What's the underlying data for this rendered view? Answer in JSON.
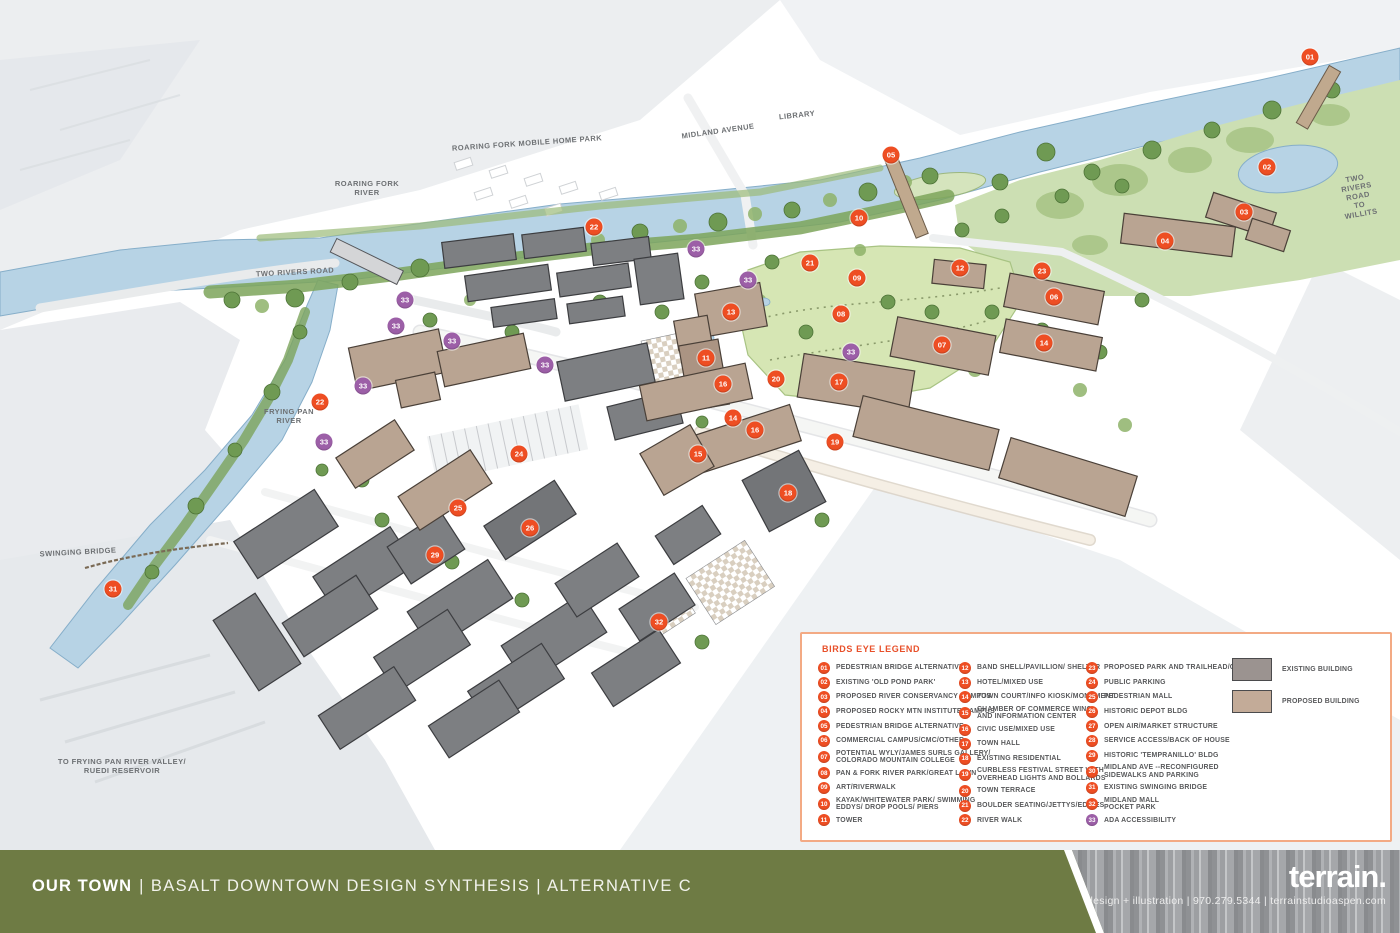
{
  "colors": {
    "marker_orange": "#ee4e23",
    "marker_purple": "#9c5fa7",
    "footer_green": "#6e7b44",
    "legend_border": "#f3aa84",
    "existing_building": "#9b9390",
    "proposed_building": "#c3ab98"
  },
  "map": {
    "labels": [
      {
        "text": "ROARING FORK MOBILE HOME PARK",
        "x": 527,
        "y": 143,
        "rot": -4
      },
      {
        "text": "MIDLAND AVENUE",
        "x": 718,
        "y": 131,
        "rot": -8
      },
      {
        "text": "LIBRARY",
        "x": 797,
        "y": 115,
        "rot": -6
      },
      {
        "text": "ROARING FORK\nRIVER",
        "x": 367,
        "y": 188,
        "rot": 0
      },
      {
        "text": "TWO RIVERS ROAD",
        "x": 295,
        "y": 272,
        "rot": -3
      },
      {
        "text": "TWO RIVERS ROAD\nTO WILLITS",
        "x": 1358,
        "y": 196,
        "rot": -10
      },
      {
        "text": "FRYING PAN\nRIVER",
        "x": 289,
        "y": 416,
        "rot": 0
      },
      {
        "text": "SWINGING BRIDGE",
        "x": 78,
        "y": 552,
        "rot": -3
      },
      {
        "text": "TO FRYING PAN RIVER VALLEY/\nRUEDI RESERVOIR",
        "x": 122,
        "y": 766,
        "rot": 0
      }
    ],
    "markers": [
      {
        "n": "01",
        "x": 1310,
        "y": 57,
        "type": "orange"
      },
      {
        "n": "02",
        "x": 1267,
        "y": 167,
        "type": "orange"
      },
      {
        "n": "03",
        "x": 1244,
        "y": 212,
        "type": "orange"
      },
      {
        "n": "04",
        "x": 1165,
        "y": 241,
        "type": "orange"
      },
      {
        "n": "05",
        "x": 891,
        "y": 155,
        "type": "orange"
      },
      {
        "n": "06",
        "x": 1054,
        "y": 297,
        "type": "orange"
      },
      {
        "n": "07",
        "x": 942,
        "y": 345,
        "type": "orange"
      },
      {
        "n": "08",
        "x": 841,
        "y": 314,
        "type": "orange"
      },
      {
        "n": "09",
        "x": 857,
        "y": 278,
        "type": "orange"
      },
      {
        "n": "10",
        "x": 859,
        "y": 218,
        "type": "orange"
      },
      {
        "n": "11",
        "x": 706,
        "y": 358,
        "type": "orange"
      },
      {
        "n": "12",
        "x": 960,
        "y": 268,
        "type": "orange"
      },
      {
        "n": "13",
        "x": 731,
        "y": 312,
        "type": "orange"
      },
      {
        "n": "14",
        "x": 1044,
        "y": 343,
        "type": "orange"
      },
      {
        "n": "14",
        "x": 733,
        "y": 418,
        "type": "orange"
      },
      {
        "n": "15",
        "x": 698,
        "y": 454,
        "type": "orange"
      },
      {
        "n": "16",
        "x": 723,
        "y": 384,
        "type": "orange"
      },
      {
        "n": "16",
        "x": 755,
        "y": 430,
        "type": "orange"
      },
      {
        "n": "17",
        "x": 839,
        "y": 382,
        "type": "orange"
      },
      {
        "n": "18",
        "x": 788,
        "y": 493,
        "type": "orange"
      },
      {
        "n": "19",
        "x": 835,
        "y": 442,
        "type": "orange"
      },
      {
        "n": "20",
        "x": 776,
        "y": 379,
        "type": "orange"
      },
      {
        "n": "21",
        "x": 810,
        "y": 263,
        "type": "orange"
      },
      {
        "n": "22",
        "x": 594,
        "y": 227,
        "type": "orange"
      },
      {
        "n": "22",
        "x": 320,
        "y": 402,
        "type": "orange"
      },
      {
        "n": "23",
        "x": 1042,
        "y": 271,
        "type": "orange"
      },
      {
        "n": "24",
        "x": 519,
        "y": 454,
        "type": "orange"
      },
      {
        "n": "25",
        "x": 458,
        "y": 508,
        "type": "orange"
      },
      {
        "n": "26",
        "x": 530,
        "y": 528,
        "type": "orange"
      },
      {
        "n": "29",
        "x": 435,
        "y": 555,
        "type": "orange"
      },
      {
        "n": "31",
        "x": 113,
        "y": 589,
        "type": "orange"
      },
      {
        "n": "32",
        "x": 659,
        "y": 622,
        "type": "orange"
      },
      {
        "n": "33",
        "x": 696,
        "y": 249,
        "type": "purple"
      },
      {
        "n": "33",
        "x": 748,
        "y": 280,
        "type": "purple"
      },
      {
        "n": "33",
        "x": 851,
        "y": 352,
        "type": "purple"
      },
      {
        "n": "33",
        "x": 405,
        "y": 300,
        "type": "purple"
      },
      {
        "n": "33",
        "x": 396,
        "y": 326,
        "type": "purple"
      },
      {
        "n": "33",
        "x": 452,
        "y": 341,
        "type": "purple"
      },
      {
        "n": "33",
        "x": 545,
        "y": 365,
        "type": "purple"
      },
      {
        "n": "33",
        "x": 363,
        "y": 386,
        "type": "purple"
      },
      {
        "n": "33",
        "x": 324,
        "y": 442,
        "type": "purple"
      }
    ]
  },
  "legend": {
    "title": "BIRDS EYE LEGEND",
    "column_offsets": [
      16,
      157,
      284
    ],
    "columns": [
      [
        {
          "n": "01",
          "text": "PEDESTRIAN BRIDGE ALTERNATIVE"
        },
        {
          "n": "02",
          "text": "EXISTING 'OLD POND PARK'"
        },
        {
          "n": "03",
          "text": "PROPOSED RIVER CONSERVANCY CAMPUS"
        },
        {
          "n": "04",
          "text": "PROPOSED ROCKY MTN INSTITUTE CAMPUS"
        },
        {
          "n": "05",
          "text": "PEDESTRIAN BRIDGE ALTERNATIVE"
        },
        {
          "n": "06",
          "text": "COMMERCIAL CAMPUS/CMC/OTHER"
        },
        {
          "n": "07",
          "text": "POTENTIAL WYLY/JAMES SURLS GALLERY/\nCOLORADO MOUNTAIN COLLEGE"
        },
        {
          "n": "08",
          "text": "PAN & FORK RIVER PARK/GREAT LAWN"
        },
        {
          "n": "09",
          "text": "ART/RIVERWALK"
        },
        {
          "n": "10",
          "text": "KAYAK/WHITEWATER PARK/ SWIMMING\nEDDYS/ DROP POOLS/ PIERS"
        },
        {
          "n": "11",
          "text": "TOWER"
        }
      ],
      [
        {
          "n": "12",
          "text": "BAND SHELL/PAVILLION/ SHELTER"
        },
        {
          "n": "13",
          "text": "HOTEL/MIXED USE"
        },
        {
          "n": "14",
          "text": "TOWN COURT/INFO KIOSK/MONUMENT"
        },
        {
          "n": "15",
          "text": "CHAMBER OF COMMERCE WING\nAND INFORMATION CENTER"
        },
        {
          "n": "16",
          "text": "CIVIC USE/MIXED USE"
        },
        {
          "n": "17",
          "text": "TOWN HALL"
        },
        {
          "n": "18",
          "text": "EXISTING RESIDENTIAL"
        },
        {
          "n": "19",
          "text": "CURBLESS FESTIVAL STREET WITH\nOVERHEAD LIGHTS AND BOLLARDS"
        },
        {
          "n": "20",
          "text": "TOWN TERRACE"
        },
        {
          "n": "21",
          "text": "BOULDER SEATING/JETTYS/EDDIES"
        },
        {
          "n": "22",
          "text": "RIVER WALK"
        }
      ],
      [
        {
          "n": "23",
          "text": "PROPOSED PARK AND TRAILHEAD/CAMPUS"
        },
        {
          "n": "24",
          "text": "PUBLIC PARKING"
        },
        {
          "n": "25",
          "text": "PEDESTRIAN MALL"
        },
        {
          "n": "26",
          "text": "HISTORIC DEPOT BLDG"
        },
        {
          "n": "27",
          "text": "OPEN AIR/MARKET STRUCTURE"
        },
        {
          "n": "28",
          "text": "SERVICE ACCESS/BACK OF HOUSE"
        },
        {
          "n": "29",
          "text": "HISTORIC 'TEMPRANILLO' BLDG"
        },
        {
          "n": "30",
          "text": "MIDLAND AVE --RECONFIGURED\nSIDEWALKS AND PARKING"
        },
        {
          "n": "31",
          "text": "EXISTING SWINGING BRIDGE"
        },
        {
          "n": "32",
          "text": "MIDLAND MALL\nPOCKET PARK"
        },
        {
          "n": "33",
          "text": "ADA ACCESSIBILITY",
          "type": "purple"
        }
      ]
    ],
    "swatches": [
      {
        "label": "EXISTING BUILDING",
        "color": "#9b9390"
      },
      {
        "label": "PROPOSED BUILDING",
        "color": "#c3ab98"
      }
    ]
  },
  "footer": {
    "title_bold": "OUR TOWN",
    "title_rest": "| BASALT DOWNTOWN DESIGN SYNTHESIS | ALTERNATIVE C",
    "brand": "terrain.",
    "brand_sub": "design + illustration  |  970.279.5344  |  terrainstudioaspen.com"
  }
}
